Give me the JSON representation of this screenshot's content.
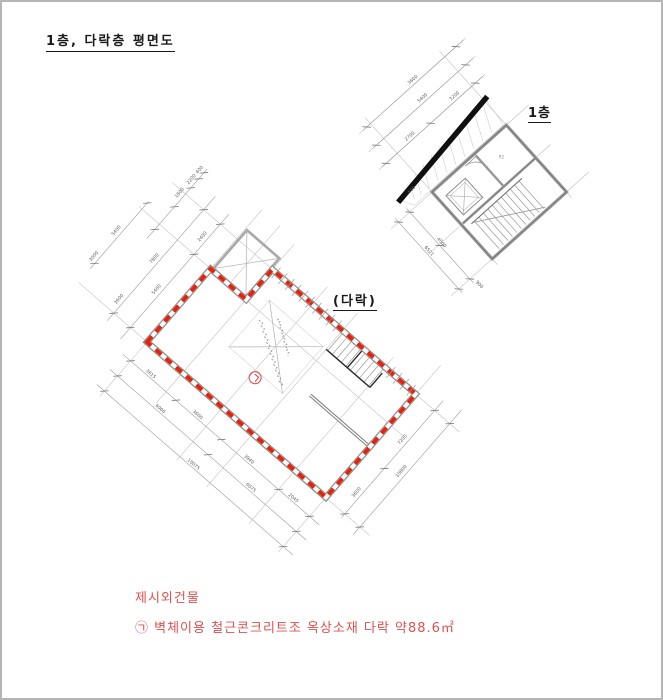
{
  "title": {
    "text": "1층, 다락층 평면도"
  },
  "floor1_plan": {
    "label": "1층",
    "room_label": "R2",
    "dims": {
      "left": [
        "2700",
        "3200",
        "5400",
        "3600"
      ],
      "bottom": [
        "600",
        "4500",
        "6521",
        "900"
      ]
    }
  },
  "attic_plan": {
    "label": "(다락)",
    "unit_mark": "㉠",
    "dims": {
      "left": [
        "400",
        "1800",
        "2200",
        "2400",
        "5400",
        "7800",
        "3600",
        "5400",
        "3000"
      ],
      "bottom": [
        "3615",
        "3600",
        "3940",
        "2045",
        "6000",
        "6075",
        "10075"
      ],
      "right": [
        "3600",
        "7200",
        "10800"
      ]
    }
  },
  "notes": {
    "line1": "제시외건물",
    "line2": "㉠ 벽체이용 철근콘크리트조 옥상소재 다락 약88.6㎡"
  },
  "colors": {
    "outline_red": "#e8220a",
    "note_red": "#e05050",
    "wall_gray": "#909090",
    "dim_gray": "#5a5a5a"
  }
}
